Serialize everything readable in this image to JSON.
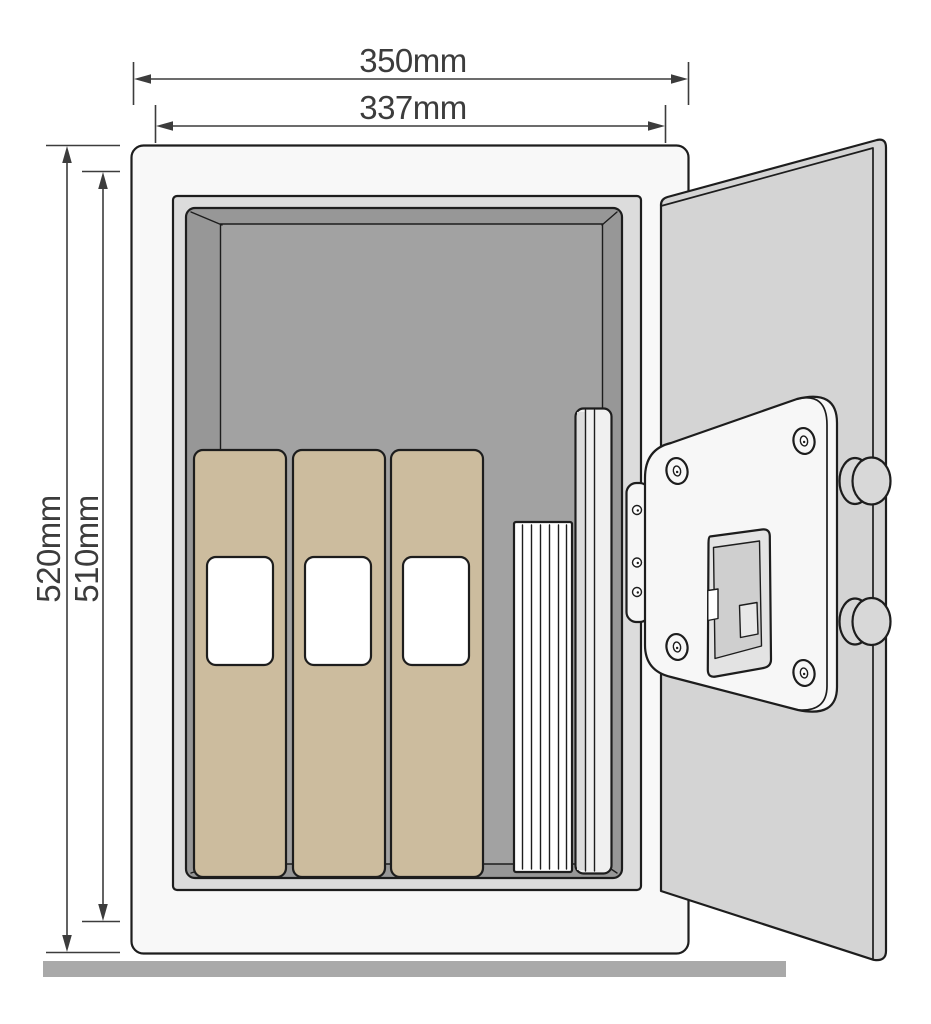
{
  "diagram": {
    "subject": "wall-safe-open-door-dimension-drawing",
    "dim_labels": {
      "outer_width": "350mm",
      "inner_width": "337mm",
      "outer_height": "520mm",
      "inner_height": "510mm"
    },
    "contents": {
      "binder_count": 3,
      "items": [
        "ring-binders",
        "document-stack",
        "tall-folder"
      ]
    },
    "colors": {
      "line": "#1d1d1d",
      "dim": "#3c3c3c",
      "body": "#f8f8f8",
      "jamb": "#dcdcdc",
      "wall": "#979797",
      "back_wall": "#a2a2a2",
      "binder": "#ccbc9e",
      "binder_label": "#ffffff",
      "paper": "#ffffff",
      "book": "#f0f0f0",
      "book_shade": "#dcdcdc",
      "door": "#d4d4d4",
      "panel": "#f7f7f7",
      "keypad_outer": "#e3e3e3",
      "keypad_inner": "#cfcfcf",
      "knob": "#d8d8d8",
      "hinge": "#f6f6f6",
      "floor": "#a9a9a9"
    }
  }
}
